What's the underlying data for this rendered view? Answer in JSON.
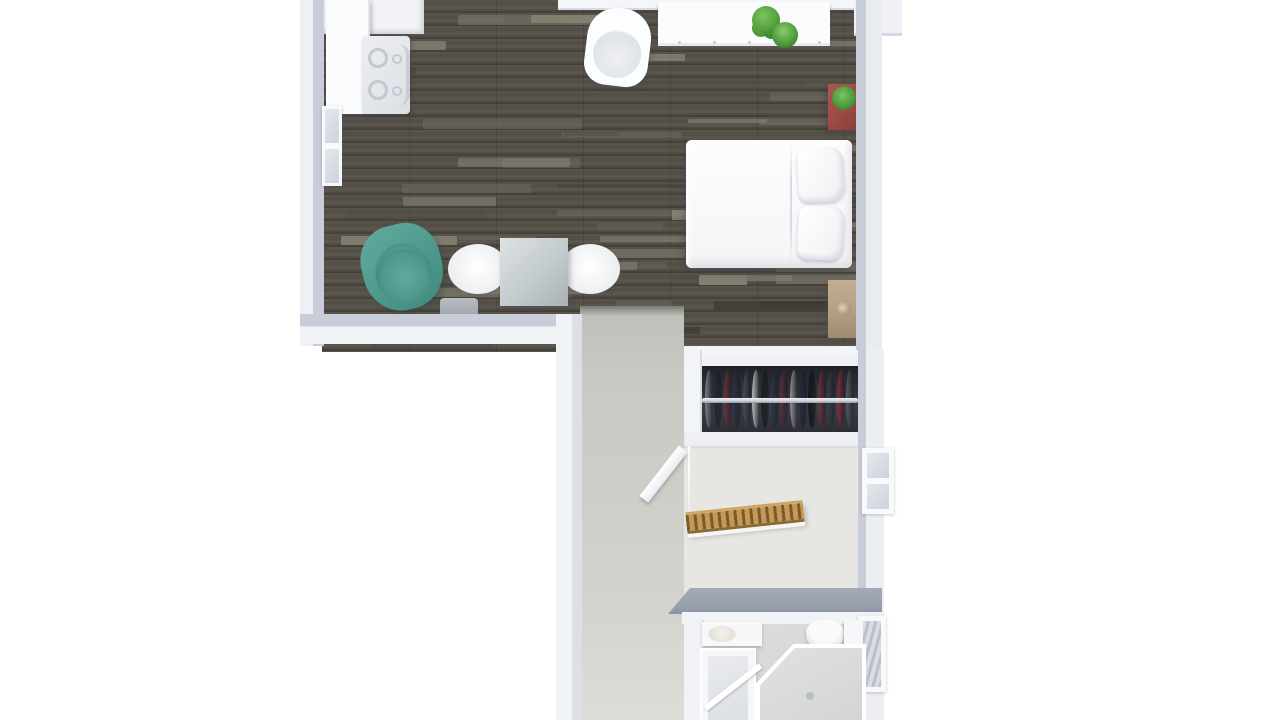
{
  "scene": {
    "type": "3d-floor-plan-top-view",
    "background": "#ffffff",
    "rooms": [
      {
        "name": "living-bedroom",
        "floor": "dark-wood-planks"
      },
      {
        "name": "kitchenette",
        "floor": "dark-wood-planks"
      },
      {
        "name": "corridor-landing",
        "floor": "gray-carpet"
      },
      {
        "name": "wardrobe-closet",
        "floor": "none"
      },
      {
        "name": "staircase",
        "floor": "light-carpet"
      },
      {
        "name": "bathroom",
        "floor": "gray-tile"
      }
    ],
    "furniture": [
      "kitchen-counter",
      "stove-with-burners",
      "sideboard",
      "desk-with-plants",
      "white-tub-chair",
      "red-nightstand-with-plant",
      "double-bed-with-pillows",
      "wooden-nightstand",
      "teal-armchair",
      "square-dining-table",
      "two-white-dining-chairs",
      "gray-bench",
      "wardrobe-with-hanging-clothes",
      "staircase-with-wooden-railing",
      "white-landing-railing",
      "bathtub",
      "corner-shower",
      "vanity-sink",
      "toilet",
      "bath-cabinet"
    ]
  },
  "colors": {
    "bg": "#ffffff",
    "wall_outer": "#f2f3f7",
    "wall_inner": "#c9cdd9",
    "wall_face_dark": "#99a0ae",
    "wood_base": "#544f47",
    "carpet_corridor": "#c9c9c3",
    "carpet_stairs": "#e6e6e3",
    "bath_floor": "#d6d8d6",
    "furn_white": "#fbfcfd",
    "teal": "#4f988c",
    "red_cabinet": "#9c4945",
    "nightstand_wood": "#b3a287",
    "railing_wood": "#c3995a",
    "railing_wood_dark": "#7b5a28",
    "plant_green": "#55a33e",
    "table_gray": "#c3cacd",
    "bench_gray": "#9ba2a9",
    "closet_bg": "#2e3138",
    "rail_metal": "#ccd1d8"
  },
  "closet": {
    "items": [
      "#7e828c",
      "#23283a",
      "#6d3140",
      "#2b3147",
      "#494c55",
      "#b9bcc2",
      "#1d2026",
      "#30364a",
      "#5e2e3c",
      "#8f939b",
      "#262b3d",
      "#15171c",
      "#6d3342",
      "#3a3e49",
      "#842f3f",
      "#565a64"
    ]
  },
  "stairs": {
    "steps": 8
  },
  "wood_texture": {
    "rows": 27,
    "row_height": 13,
    "strip_count": 55,
    "palette": [
      "#6e6a5f",
      "#817c6f",
      "#94907f",
      "#3b3933",
      "#504d45",
      "#a09a8a"
    ]
  }
}
